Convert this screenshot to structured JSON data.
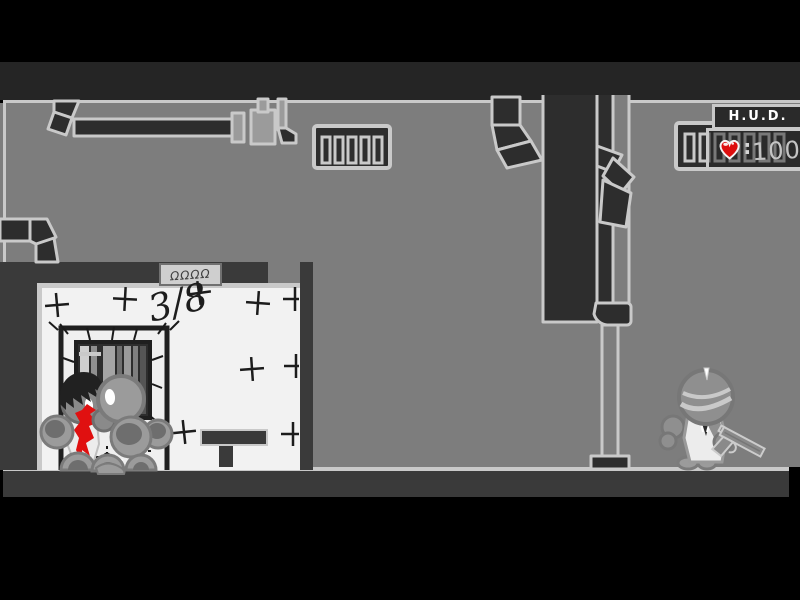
{
  "hud": {
    "title": "H.U.D.",
    "health": {
      "icon": "heart-icon",
      "separator": ":",
      "value": "100"
    }
  },
  "level": {
    "door_sign": "ΩΩΩΩ",
    "wall_marking": "3/8"
  },
  "entities": [
    {
      "name": "guard-with-pistol",
      "location": "right-corridor"
    },
    {
      "name": "dead-character-with-blood",
      "location": "tiled-room"
    },
    {
      "name": "pile-of-heads",
      "location": "tiled-room"
    }
  ],
  "palette": {
    "wall": "#7d7d7d",
    "structure_dark": "#3a3a3a",
    "duct_dark": "#2d2d2d",
    "outline_light": "#c9c9c9",
    "room_white": "#f2f2f2",
    "blood_red": "#e01010",
    "heart_red": "#dd0e0e",
    "hud_title_color": "#ffffff",
    "hud_value_color": "#c4c4c4"
  }
}
